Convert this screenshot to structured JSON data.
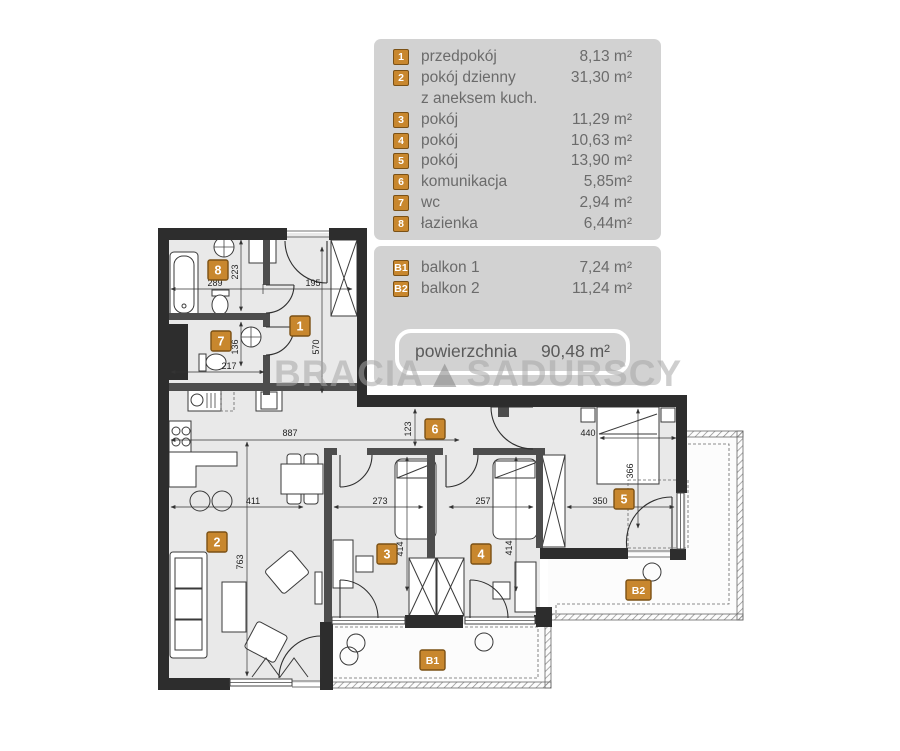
{
  "legend": {
    "rooms": [
      {
        "id": "1",
        "name": "przedpokój",
        "area": "8,13 m²"
      },
      {
        "id": "2",
        "name": "pokój dzienny",
        "name2": "z aneksem kuch.",
        "area": "31,30 m²"
      },
      {
        "id": "3",
        "name": "pokój",
        "area": "11,29 m²"
      },
      {
        "id": "4",
        "name": "pokój",
        "area": "10,63 m²"
      },
      {
        "id": "5",
        "name": "pokój",
        "area": "13,90 m²"
      },
      {
        "id": "6",
        "name": "komunikacja",
        "area": "5,85m²"
      },
      {
        "id": "7",
        "name": "wc",
        "area": "2,94 m²"
      },
      {
        "id": "8",
        "name": "łazienka",
        "area": "6,44m²"
      }
    ],
    "balconies": [
      {
        "id": "B1",
        "name": "balkon 1",
        "area": "7,24 m²"
      },
      {
        "id": "B2",
        "name": "balkon 2",
        "area": "11,24 m²"
      }
    ],
    "total_label": "powierzchnia",
    "total_area": "90,48 m²"
  },
  "watermark": {
    "part1": "BRACIA",
    "part2": "SADURSCY",
    "logo": "triangle-logo"
  },
  "plan": {
    "room_labels": [
      {
        "id": "1"
      },
      {
        "id": "2"
      },
      {
        "id": "3"
      },
      {
        "id": "4"
      },
      {
        "id": "5"
      },
      {
        "id": "6"
      },
      {
        "id": "7"
      },
      {
        "id": "8"
      },
      {
        "id": "B1"
      },
      {
        "id": "B2"
      }
    ],
    "dimensions": [
      {
        "v": "289"
      },
      {
        "v": "195"
      },
      {
        "v": "223"
      },
      {
        "v": "570"
      },
      {
        "v": "217"
      },
      {
        "v": "136"
      },
      {
        "v": "887"
      },
      {
        "v": "123"
      },
      {
        "v": "440"
      },
      {
        "v": "411"
      },
      {
        "v": "273"
      },
      {
        "v": "257"
      },
      {
        "v": "350"
      },
      {
        "v": "763"
      },
      {
        "v": "414"
      },
      {
        "v": "414"
      },
      {
        "v": "366"
      }
    ]
  },
  "colors": {
    "wall": "#2d2d2d",
    "inner_wall": "#4d4d4d",
    "floor": "#e9e9e9",
    "badge": "#c8872e",
    "badge_border": "#7b5115",
    "legend_bg": "#d2d2d2",
    "legend_text": "#6b6b6b",
    "dim_text": "#222222"
  }
}
